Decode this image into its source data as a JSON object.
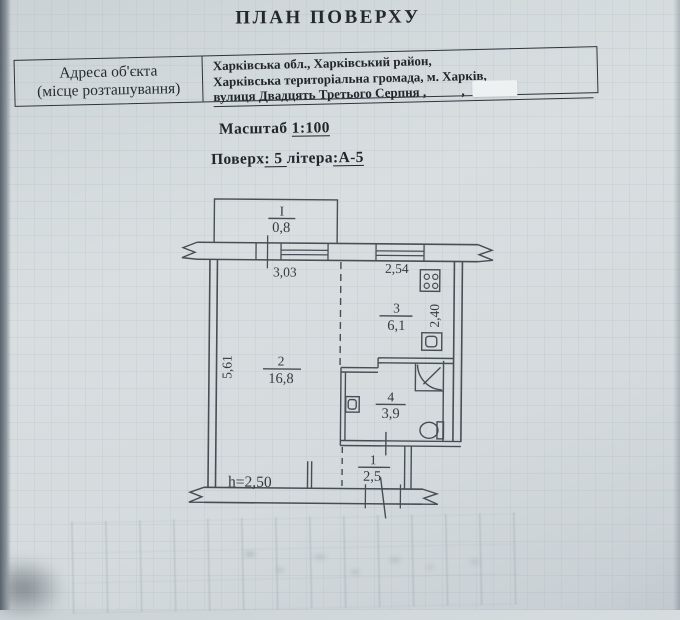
{
  "document": {
    "title": "ПЛАН ПОВЕРХУ",
    "address_table": {
      "label_line1": "Адреса об'єкта",
      "label_line2": "(місце розташування)",
      "line1": "Харківська обл., Харківський район,",
      "line2": "Харківська територіальна громада, м. Харків,",
      "line3": "вулиця Двадцять Третього Серпня ,",
      "suffix_comma": ",",
      "redaction_note": ""
    },
    "scale": {
      "label": "Масштаб",
      "value": "1:100"
    },
    "floor": {
      "prefix": "Поверх",
      "number_part": ": 5 ",
      "letter_label": "літера",
      "letter_part": ":А-5"
    }
  },
  "plan": {
    "balcony": {
      "number": "I",
      "area": "0,8"
    },
    "rooms": [
      {
        "number": "1",
        "area": "2,5"
      },
      {
        "number": "2",
        "area": "16,8"
      },
      {
        "number": "3",
        "area": "6,1"
      },
      {
        "number": "4",
        "area": "3,9"
      }
    ],
    "dimensions": {
      "window_left": "3,03",
      "window_right": "2,54",
      "wall_left": "5,61",
      "wall_right": "2,40"
    },
    "height_note": "h=2,50",
    "fixture_icons": [
      "stove-icon",
      "sink-icon",
      "corner-bath-icon",
      "washbasin-icon",
      "toilet-icon"
    ]
  }
}
